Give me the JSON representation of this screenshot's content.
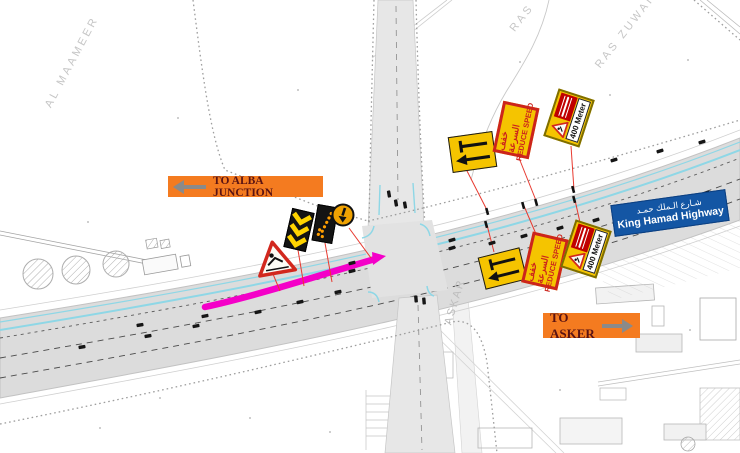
{
  "banners": {
    "alba": {
      "label": "TO ALBA JUNCTION"
    },
    "asker": {
      "label": "TO ASKER"
    }
  },
  "highway_sign": {
    "arabic": "شـارع الـملك حمـد",
    "english": "King Hamad Highway"
  },
  "work_signs": {
    "reduce_speed": {
      "arabic": "خفف السرعة",
      "english": "REDUCE SPEED"
    },
    "distance": {
      "label": "400 Meter"
    }
  },
  "place_labels": {
    "al_maameer": "AL MAAMEER",
    "ras": "RAS",
    "ras_zuwaid": "RAS ZUWAID",
    "askar": "ASKAR"
  },
  "colors": {
    "accent_orange": "#F47B20",
    "banner_text": "#5A1313",
    "arrow_gray": "#8A8A8A",
    "sign_yellow": "#F5C400",
    "sign_red": "#CC241C",
    "sign_olive": "#7E6E00",
    "panel_red": "#C00000",
    "board_black": "#141414",
    "chevron_yellow": "#FFD400",
    "lamp_orange": "#FF9E00",
    "keep_left_amber": "#F0A202",
    "highway_blue": "#1456A4",
    "closure_magenta": "#F400C8",
    "cyan": "#8ED7E6",
    "leader_red": "#E8392F"
  },
  "vehicles": [
    [
      82,
      347,
      -10
    ],
    [
      148,
      336,
      -10
    ],
    [
      196,
      326,
      -11
    ],
    [
      258,
      312,
      -12
    ],
    [
      300,
      302,
      -13
    ],
    [
      338,
      292,
      -13
    ],
    [
      140,
      325,
      -10
    ],
    [
      205,
      316,
      -11
    ],
    [
      352,
      263,
      -14
    ],
    [
      352,
      271,
      -14
    ],
    [
      452,
      240,
      -16
    ],
    [
      452,
      248,
      -16
    ],
    [
      396,
      203,
      80
    ],
    [
      405,
      205,
      80
    ],
    [
      389,
      194,
      80
    ],
    [
      416,
      299,
      85
    ],
    [
      424,
      301,
      85
    ],
    [
      492,
      243,
      -16
    ],
    [
      524,
      236,
      -16
    ],
    [
      560,
      228,
      -17
    ],
    [
      596,
      220,
      -17
    ],
    [
      634,
      211,
      -18
    ],
    [
      672,
      202,
      -18
    ],
    [
      706,
      193,
      -18
    ],
    [
      614,
      160,
      -18
    ],
    [
      660,
      151,
      -18
    ],
    [
      702,
      142,
      -18
    ]
  ]
}
